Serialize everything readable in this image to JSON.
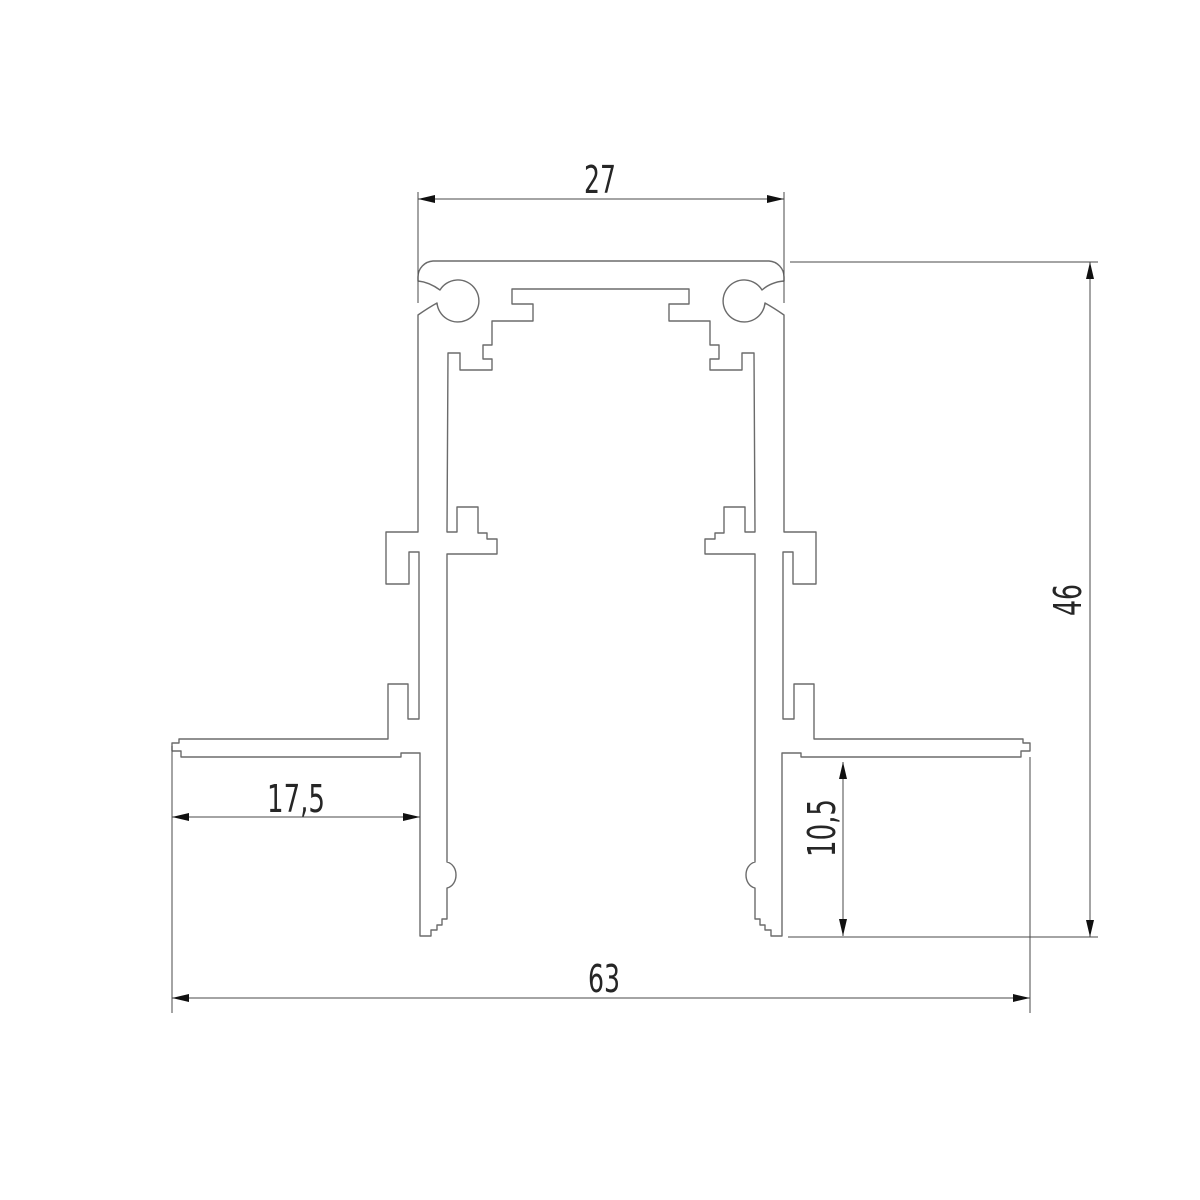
{
  "drawing": {
    "type": "technical-cross-section",
    "subject": "recessed mounting profile cross-section",
    "background_color": "#ffffff",
    "profile_line_color": "#6b6b6b",
    "dimension_line_color": "#4a4a4a",
    "arrow_color": "#101010",
    "text_color": "#262626",
    "dimensions": {
      "top_width": {
        "value": "27",
        "orientation": "horizontal",
        "position": "top"
      },
      "overall_height": {
        "value": "46",
        "orientation": "vertical",
        "position": "right"
      },
      "flange_width": {
        "value": "17,5",
        "orientation": "horizontal",
        "position": "left-middle"
      },
      "recess_depth": {
        "value": "10,5",
        "orientation": "vertical",
        "position": "right-middle"
      },
      "overall_width": {
        "value": "63",
        "orientation": "horizontal",
        "position": "bottom"
      }
    }
  }
}
